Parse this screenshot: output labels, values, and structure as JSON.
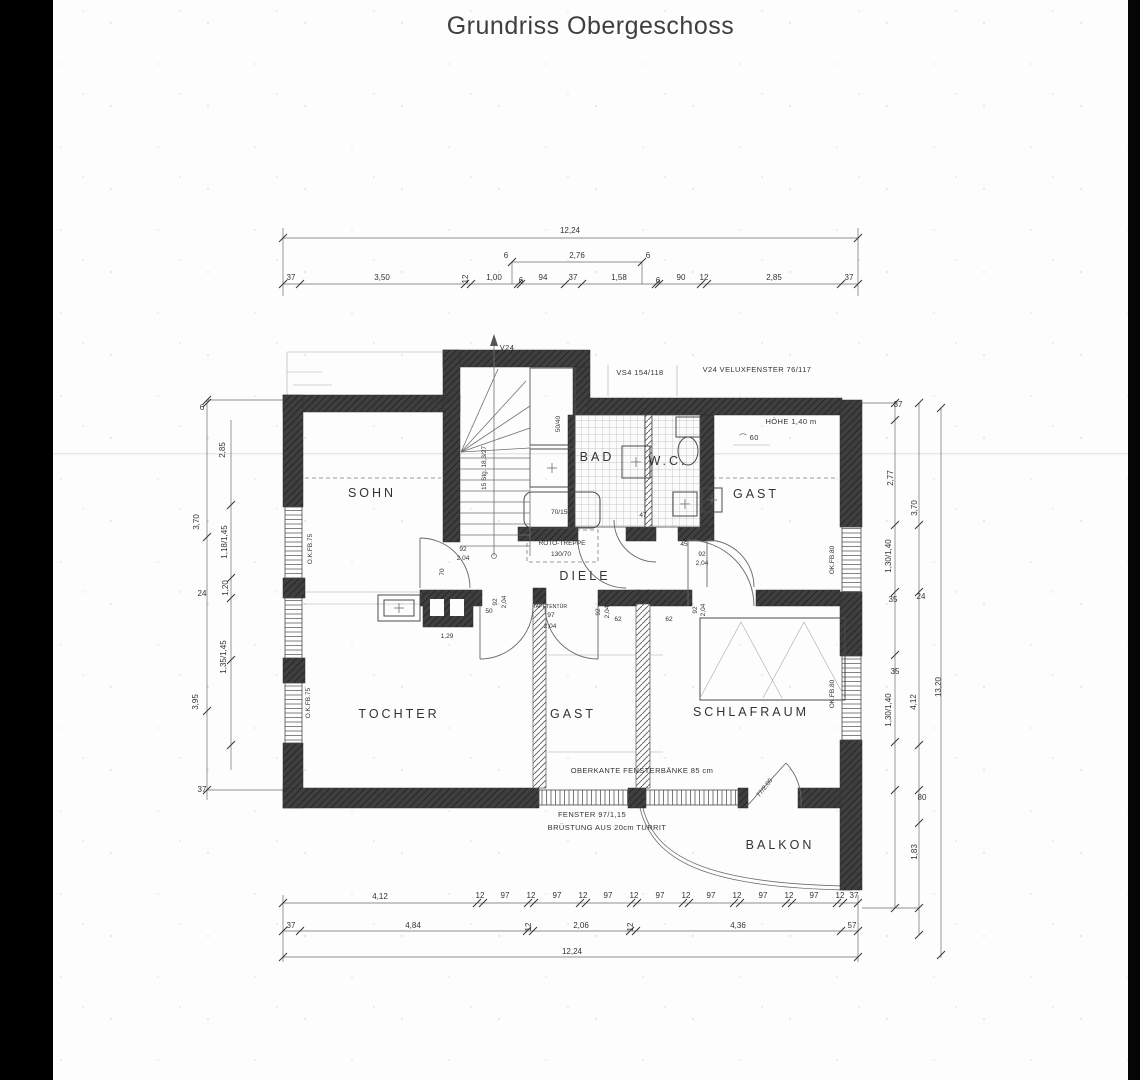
{
  "title": "Grundriss Obergeschoss",
  "plan": {
    "rooms": [
      {
        "label": "SOHN",
        "x": 372,
        "y": 497
      },
      {
        "label": "BAD",
        "x": 597,
        "y": 461
      },
      {
        "label": "W.C.",
        "x": 668,
        "y": 465
      },
      {
        "label": "GAST",
        "x": 756,
        "y": 498
      },
      {
        "label": "DIELE",
        "x": 585,
        "y": 580
      },
      {
        "label": "TOCHTER",
        "x": 399,
        "y": 718
      },
      {
        "label": "GAST",
        "x": 573,
        "y": 718
      },
      {
        "label": "SCHLAFRAUM",
        "x": 751,
        "y": 716
      },
      {
        "label": "BALKON",
        "x": 780,
        "y": 849
      }
    ],
    "labels": [
      {
        "t": "50/60",
        "x": 441,
        "y": 403,
        "c": "a"
      },
      {
        "t": "V24",
        "x": 507,
        "y": 350,
        "c": "a"
      },
      {
        "t": "VS4 154/118",
        "x": 640,
        "y": 375,
        "c": "a"
      },
      {
        "t": "V24 VELUXFENSTER 76/117",
        "x": 757,
        "y": 372,
        "c": "a"
      },
      {
        "t": "HÖHE 1,40 m",
        "x": 791,
        "y": 424,
        "c": "a"
      },
      {
        "t": "⌒ 60",
        "x": 749,
        "y": 440,
        "c": "a"
      },
      {
        "t": "ROTO-TREPPE",
        "x": 562,
        "y": 545,
        "c": "t"
      },
      {
        "t": "130/70",
        "x": 561,
        "y": 556,
        "c": "t"
      },
      {
        "t": "70/150",
        "x": 561,
        "y": 514,
        "c": "t"
      },
      {
        "t": "50/40",
        "x": 560,
        "y": 424,
        "r": -90,
        "c": "t"
      },
      {
        "t": "15 Stg. 18,3/27",
        "x": 486,
        "y": 468,
        "r": -90,
        "c": "t"
      },
      {
        "t": "O.K.FB.75",
        "x": 312,
        "y": 549,
        "r": -90,
        "c": "t"
      },
      {
        "t": "O.K.FB.75",
        "x": 310,
        "y": 703,
        "r": -90,
        "c": "t"
      },
      {
        "t": "OK.FB.80",
        "x": 834,
        "y": 560,
        "r": -90,
        "c": "t"
      },
      {
        "t": "OK.FB.80",
        "x": 834,
        "y": 694,
        "r": -90,
        "c": "t"
      },
      {
        "t": "OBERKANTE FENSTERBÄNKE 85 cm",
        "x": 642,
        "y": 773,
        "c": "a"
      },
      {
        "t": "FENSTER 97/1,15",
        "x": 592,
        "y": 817,
        "c": "a"
      },
      {
        "t": "BRÜSTUNG AUS 20cm TURRIT",
        "x": 607,
        "y": 830,
        "c": "a"
      },
      {
        "t": "77/2,00",
        "x": 766,
        "y": 789,
        "r": -52,
        "c": "t"
      },
      {
        "t": "TAPETENTÜR",
        "x": 550,
        "y": 608,
        "c": "s"
      },
      {
        "t": "12,24",
        "x": 570,
        "y": 233
      },
      {
        "t": "2,76",
        "x": 577,
        "y": 258
      },
      {
        "t": "6",
        "x": 506,
        "y": 258
      },
      {
        "t": "6",
        "x": 648,
        "y": 258
      },
      {
        "t": "37",
        "x": 291,
        "y": 280
      },
      {
        "t": "3,50",
        "x": 382,
        "y": 280
      },
      {
        "t": "12",
        "x": 468,
        "y": 279,
        "r": -90
      },
      {
        "t": "1,00",
        "x": 494,
        "y": 280
      },
      {
        "t": "6",
        "x": 521,
        "y": 283
      },
      {
        "t": "94",
        "x": 543,
        "y": 280
      },
      {
        "t": "37",
        "x": 573,
        "y": 280
      },
      {
        "t": "1,58",
        "x": 619,
        "y": 280
      },
      {
        "t": "6",
        "x": 658,
        "y": 283
      },
      {
        "t": "90",
        "x": 681,
        "y": 280
      },
      {
        "t": "12",
        "x": 704,
        "y": 280
      },
      {
        "t": "2,85",
        "x": 774,
        "y": 280
      },
      {
        "t": "37",
        "x": 849,
        "y": 280
      },
      {
        "t": "4,12",
        "x": 380,
        "y": 899
      },
      {
        "t": "12",
        "x": 480,
        "y": 898
      },
      {
        "t": "97",
        "x": 505,
        "y": 898
      },
      {
        "t": "12",
        "x": 531,
        "y": 898
      },
      {
        "t": "97",
        "x": 557,
        "y": 898
      },
      {
        "t": "12",
        "x": 583,
        "y": 898
      },
      {
        "t": "97",
        "x": 608,
        "y": 898
      },
      {
        "t": "12",
        "x": 634,
        "y": 898
      },
      {
        "t": "97",
        "x": 660,
        "y": 898
      },
      {
        "t": "12",
        "x": 686,
        "y": 898
      },
      {
        "t": "97",
        "x": 711,
        "y": 898
      },
      {
        "t": "12",
        "x": 737,
        "y": 898
      },
      {
        "t": "97",
        "x": 763,
        "y": 898
      },
      {
        "t": "12",
        "x": 789,
        "y": 898
      },
      {
        "t": "97",
        "x": 814,
        "y": 898
      },
      {
        "t": "12",
        "x": 840,
        "y": 898
      },
      {
        "t": "37",
        "x": 854,
        "y": 898
      },
      {
        "t": "37",
        "x": 291,
        "y": 928
      },
      {
        "t": "4,84",
        "x": 413,
        "y": 928
      },
      {
        "t": "12",
        "x": 531,
        "y": 927,
        "r": -90
      },
      {
        "t": "2,06",
        "x": 581,
        "y": 928
      },
      {
        "t": "12",
        "x": 633,
        "y": 927,
        "r": -90
      },
      {
        "t": "4,36",
        "x": 738,
        "y": 928
      },
      {
        "t": "57",
        "x": 852,
        "y": 928
      },
      {
        "t": "12,24",
        "x": 572,
        "y": 954
      },
      {
        "t": "6",
        "x": 202,
        "y": 410
      },
      {
        "t": "2,85",
        "x": 225,
        "y": 450,
        "r": -90
      },
      {
        "t": "3,70",
        "x": 199,
        "y": 522,
        "r": -90
      },
      {
        "t": "1,18/1,45",
        "x": 227,
        "y": 542,
        "r": -90
      },
      {
        "t": "1,20",
        "x": 228,
        "y": 588,
        "r": -90
      },
      {
        "t": "24",
        "x": 202,
        "y": 596
      },
      {
        "t": "1,35/1,45",
        "x": 226,
        "y": 657,
        "r": -90
      },
      {
        "t": "3,95",
        "x": 198,
        "y": 702,
        "r": -90
      },
      {
        "t": "37",
        "x": 202,
        "y": 792
      },
      {
        "t": "37",
        "x": 898,
        "y": 407
      },
      {
        "t": "2,77",
        "x": 893,
        "y": 478,
        "r": -90
      },
      {
        "t": "3,70",
        "x": 917,
        "y": 508,
        "r": -90
      },
      {
        "t": "1,30/1,40",
        "x": 891,
        "y": 556,
        "r": -90
      },
      {
        "t": "35",
        "x": 893,
        "y": 602
      },
      {
        "t": "24",
        "x": 921,
        "y": 599
      },
      {
        "t": "35",
        "x": 895,
        "y": 674
      },
      {
        "t": "1,30/1,40",
        "x": 891,
        "y": 710,
        "r": -90
      },
      {
        "t": "4,12",
        "x": 916,
        "y": 702,
        "r": -90
      },
      {
        "t": "80",
        "x": 922,
        "y": 800
      },
      {
        "t": "1,83",
        "x": 917,
        "y": 852,
        "r": -90
      },
      {
        "t": "13,20",
        "x": 941,
        "y": 687,
        "r": -90
      },
      {
        "t": "92",
        "x": 463,
        "y": 551,
        "c": "t"
      },
      {
        "t": "2,04",
        "x": 463,
        "y": 560,
        "c": "t"
      },
      {
        "t": "70",
        "x": 444,
        "y": 572,
        "r": -90,
        "c": "t"
      },
      {
        "t": "50",
        "x": 489,
        "y": 613,
        "c": "t"
      },
      {
        "t": "1,29",
        "x": 447,
        "y": 638,
        "c": "t"
      },
      {
        "t": "92",
        "x": 497,
        "y": 602,
        "r": -90,
        "c": "t"
      },
      {
        "t": "2,04",
        "x": 506,
        "y": 602,
        "r": -90,
        "c": "t"
      },
      {
        "t": "97",
        "x": 551,
        "y": 617,
        "c": "t"
      },
      {
        "t": "2,04",
        "x": 550,
        "y": 628,
        "c": "t"
      },
      {
        "t": "92",
        "x": 600,
        "y": 612,
        "r": -90,
        "c": "t"
      },
      {
        "t": "2,04",
        "x": 609,
        "y": 612,
        "r": -90,
        "c": "t"
      },
      {
        "t": "62",
        "x": 618,
        "y": 621,
        "c": "t"
      },
      {
        "t": "62",
        "x": 669,
        "y": 621,
        "c": "t"
      },
      {
        "t": "92",
        "x": 697,
        "y": 610,
        "r": -90,
        "c": "t"
      },
      {
        "t": "2,04",
        "x": 705,
        "y": 610,
        "r": -90,
        "c": "t"
      },
      {
        "t": "92",
        "x": 702,
        "y": 556,
        "c": "t"
      },
      {
        "t": "2,04",
        "x": 702,
        "y": 565,
        "c": "t"
      },
      {
        "t": "47",
        "x": 643,
        "y": 517,
        "c": "t"
      },
      {
        "t": "45",
        "x": 684,
        "y": 546,
        "c": "t"
      }
    ]
  }
}
